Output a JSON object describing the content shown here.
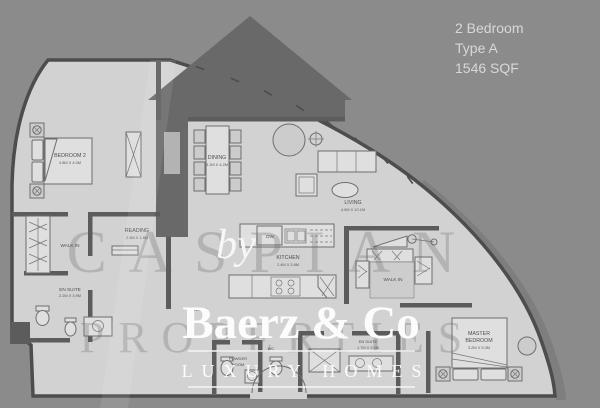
{
  "header": {
    "line1": "2 Bedroom",
    "line2": "Type A",
    "line3": "1546 SQF"
  },
  "watermark": {
    "by": "by",
    "brand": "Baerz & Co",
    "tagline": "LUXURY HOMES",
    "ghost_line1": "CASPIAN",
    "ghost_line2": "PROPERTIES"
  },
  "rooms": {
    "bedroom2": {
      "name": "BEDROOM 2",
      "dims": "4.8M X 4.0M"
    },
    "dining": {
      "name": "DINING",
      "dims": "4.1M X 4.2M"
    },
    "living": {
      "name": "LIVING",
      "dims": "4.0M X 10.1M"
    },
    "reading": {
      "name": "READING",
      "dims": "2.3M X 1.8M"
    },
    "walk_in_left": {
      "name": "WALK IN"
    },
    "en_suite_left": {
      "name": "EN SUITE",
      "dims": "2.2M X 3.9M"
    },
    "kitchen": {
      "name": "KITCHEN",
      "dims": "2.4M X 3.8M"
    },
    "dishwasher": {
      "name": "DW"
    },
    "entry": {
      "name": "ENTRY"
    },
    "powder_room": {
      "line1": "POWDER",
      "line2": "ROOM"
    },
    "wc": {
      "name": "WC"
    },
    "walk_in_master": {
      "name": "WALK IN"
    },
    "master_bedroom": {
      "line1": "MASTER",
      "line2": "BEDROOM",
      "dims": "3.2M X 5.0M"
    },
    "en_suite_master": {
      "name": "EN SUITE",
      "dims": "1.7M X 3.0M"
    }
  },
  "colors": {
    "background": "#8b8b8b",
    "silhouette": "#696969",
    "floor": "#d2d2d2",
    "wall": "#5c5c5c",
    "outline": "#4d4d4d",
    "watermark_white": "#fafafa",
    "label": "#4f4f4f"
  }
}
